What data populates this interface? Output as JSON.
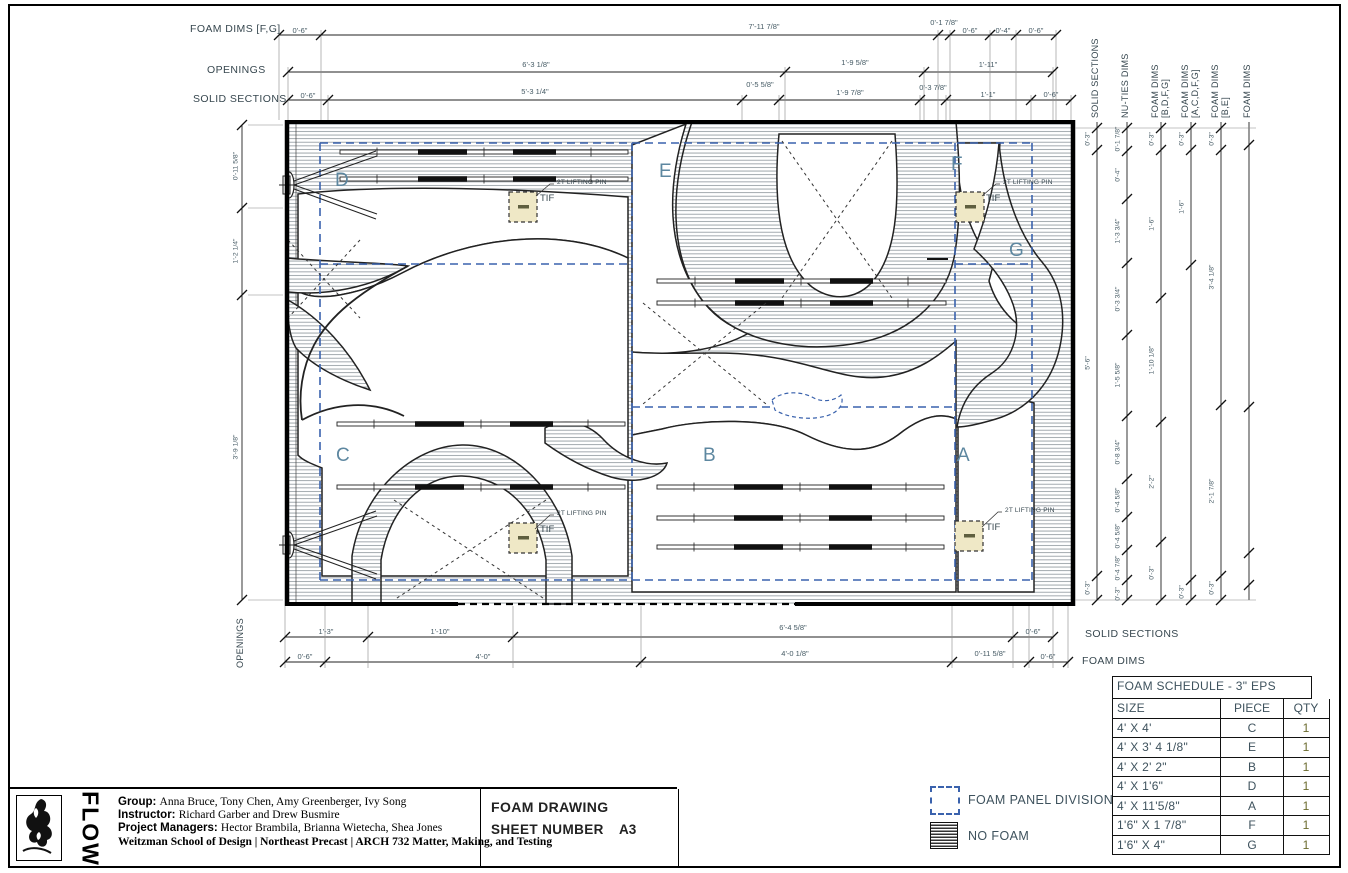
{
  "sheet_info": {
    "title": "FOAM DRAWING",
    "sheet_label": "SHEET NUMBER",
    "number": "A3"
  },
  "title_block": {
    "logo": "FLOW",
    "group_label": "Group:",
    "group": "Anna Bruce, Tony Chen, Amy Greenberger, Ivy Song",
    "instructor_label": "Instructor:",
    "instructor": "Richard Garber and Drew Busmire",
    "pm_label": "Project Managers:",
    "pm": "Hector Brambila, Brianna Wietecha, Shea Jones",
    "footer": "Weitzman School of Design | Northeast Precast | ARCH 732 Matter, Making, and Testing"
  },
  "legend": {
    "panel_division": "FOAM PANEL DIVISION",
    "no_foam": "NO FOAM"
  },
  "schedule": {
    "title": "FOAM SCHEDULE - 3\" EPS",
    "columns": [
      "SIZE",
      "PIECE",
      "QTY"
    ],
    "rows": [
      [
        "4' X 4'",
        "C",
        "1"
      ],
      [
        "4' X 3' 4 1/8\"",
        "E",
        "1"
      ],
      [
        "4' X 2' 2\"",
        "B",
        "1"
      ],
      [
        "4' X 1'6\"",
        "D",
        "1"
      ],
      [
        "4' X 11'5/8\"",
        "A",
        "1"
      ],
      [
        "1'6\" X 1 7/8\"",
        "F",
        "1"
      ],
      [
        "1'6\" X 4\"",
        "G",
        "1"
      ]
    ]
  },
  "piece_labels": {
    "a": "A",
    "b": "B",
    "c": "C",
    "d": "D",
    "e": "E",
    "f": "F",
    "g": "G"
  },
  "annotations": {
    "lifting_pin": "2T LIFTING PIN",
    "pin_tag": "TIF"
  },
  "dim_labels": {
    "top1": "FOAM DIMS [F,G]",
    "top2": "OPENINGS",
    "top3": "SOLID SECTIONS",
    "bottom1": "SOLID SECTIONS",
    "bottom2": "FOAM DIMS",
    "left": "OPENINGS"
  },
  "dims": {
    "top1": [
      "0'-6\"",
      "7'-11 7/8\"",
      "0'-1 7/8\"",
      "0'-6\"",
      "0'-4\"",
      "0'-6\""
    ],
    "top2": [
      "6'-3 1/8\"",
      "1'-9 5/8\"",
      "1'-11\""
    ],
    "top3": [
      "0'-6\"",
      "5'-3 1/4\"",
      "0'-5 5/8\"",
      "1'-9 7/8\"",
      "0'-3 7/8\"",
      "1'-1\"",
      "0'-6\""
    ],
    "bottom1": [
      "1'-3\"",
      "1'-10\"",
      "6'-4 5/8\"",
      "0'-6\""
    ],
    "bottom2": [
      "0'-6\"",
      "4'-0\"",
      "4'-0 1/8\"",
      "0'-11 5/8\"",
      "0'-6\""
    ],
    "left": [
      "0'-11 5/8\"",
      "1'-2 1/4\"",
      "3'-9 1/8\""
    ]
  },
  "right_cols": [
    {
      "label1": "SOLID SECTIONS",
      "label2": "",
      "dims": [
        "0'-3\"",
        "5'-6\"",
        "0'-3\""
      ]
    },
    {
      "label1": "NU-TIES DIMS",
      "label2": "",
      "dims": [
        "0'-1 7/8\"",
        "0'-4\"",
        "1'-3 3/4\"",
        "0'-3 3/4\"",
        "1'-5 5/8\"",
        "0'-8 3/4\"",
        "0'-4 5/8\"",
        "0'-4 5/8\"",
        "0'-4 7/8\"",
        "0'-3\""
      ]
    },
    {
      "label1": "FOAM DIMS",
      "label2": "[B,D,F,G]",
      "dims": [
        "0'-3\"",
        "1'-6\"",
        "1'-10 1/8\"",
        "2'-2\"",
        "0'-3\""
      ]
    },
    {
      "label1": "FOAM DIMS",
      "label2": "[A,C,D,F,G]",
      "dims": [
        "0'-3\"",
        "1'-6\"",
        "0'-3\""
      ]
    },
    {
      "label1": "FOAM DIMS",
      "label2": "[B,E]",
      "dims": [
        "0'-3\"",
        "3'-4 1/8\"",
        "2'-1 7/8\"",
        "0'-3\""
      ]
    },
    {
      "label1": "FOAM DIMS",
      "label2": "",
      "dims": []
    }
  ]
}
